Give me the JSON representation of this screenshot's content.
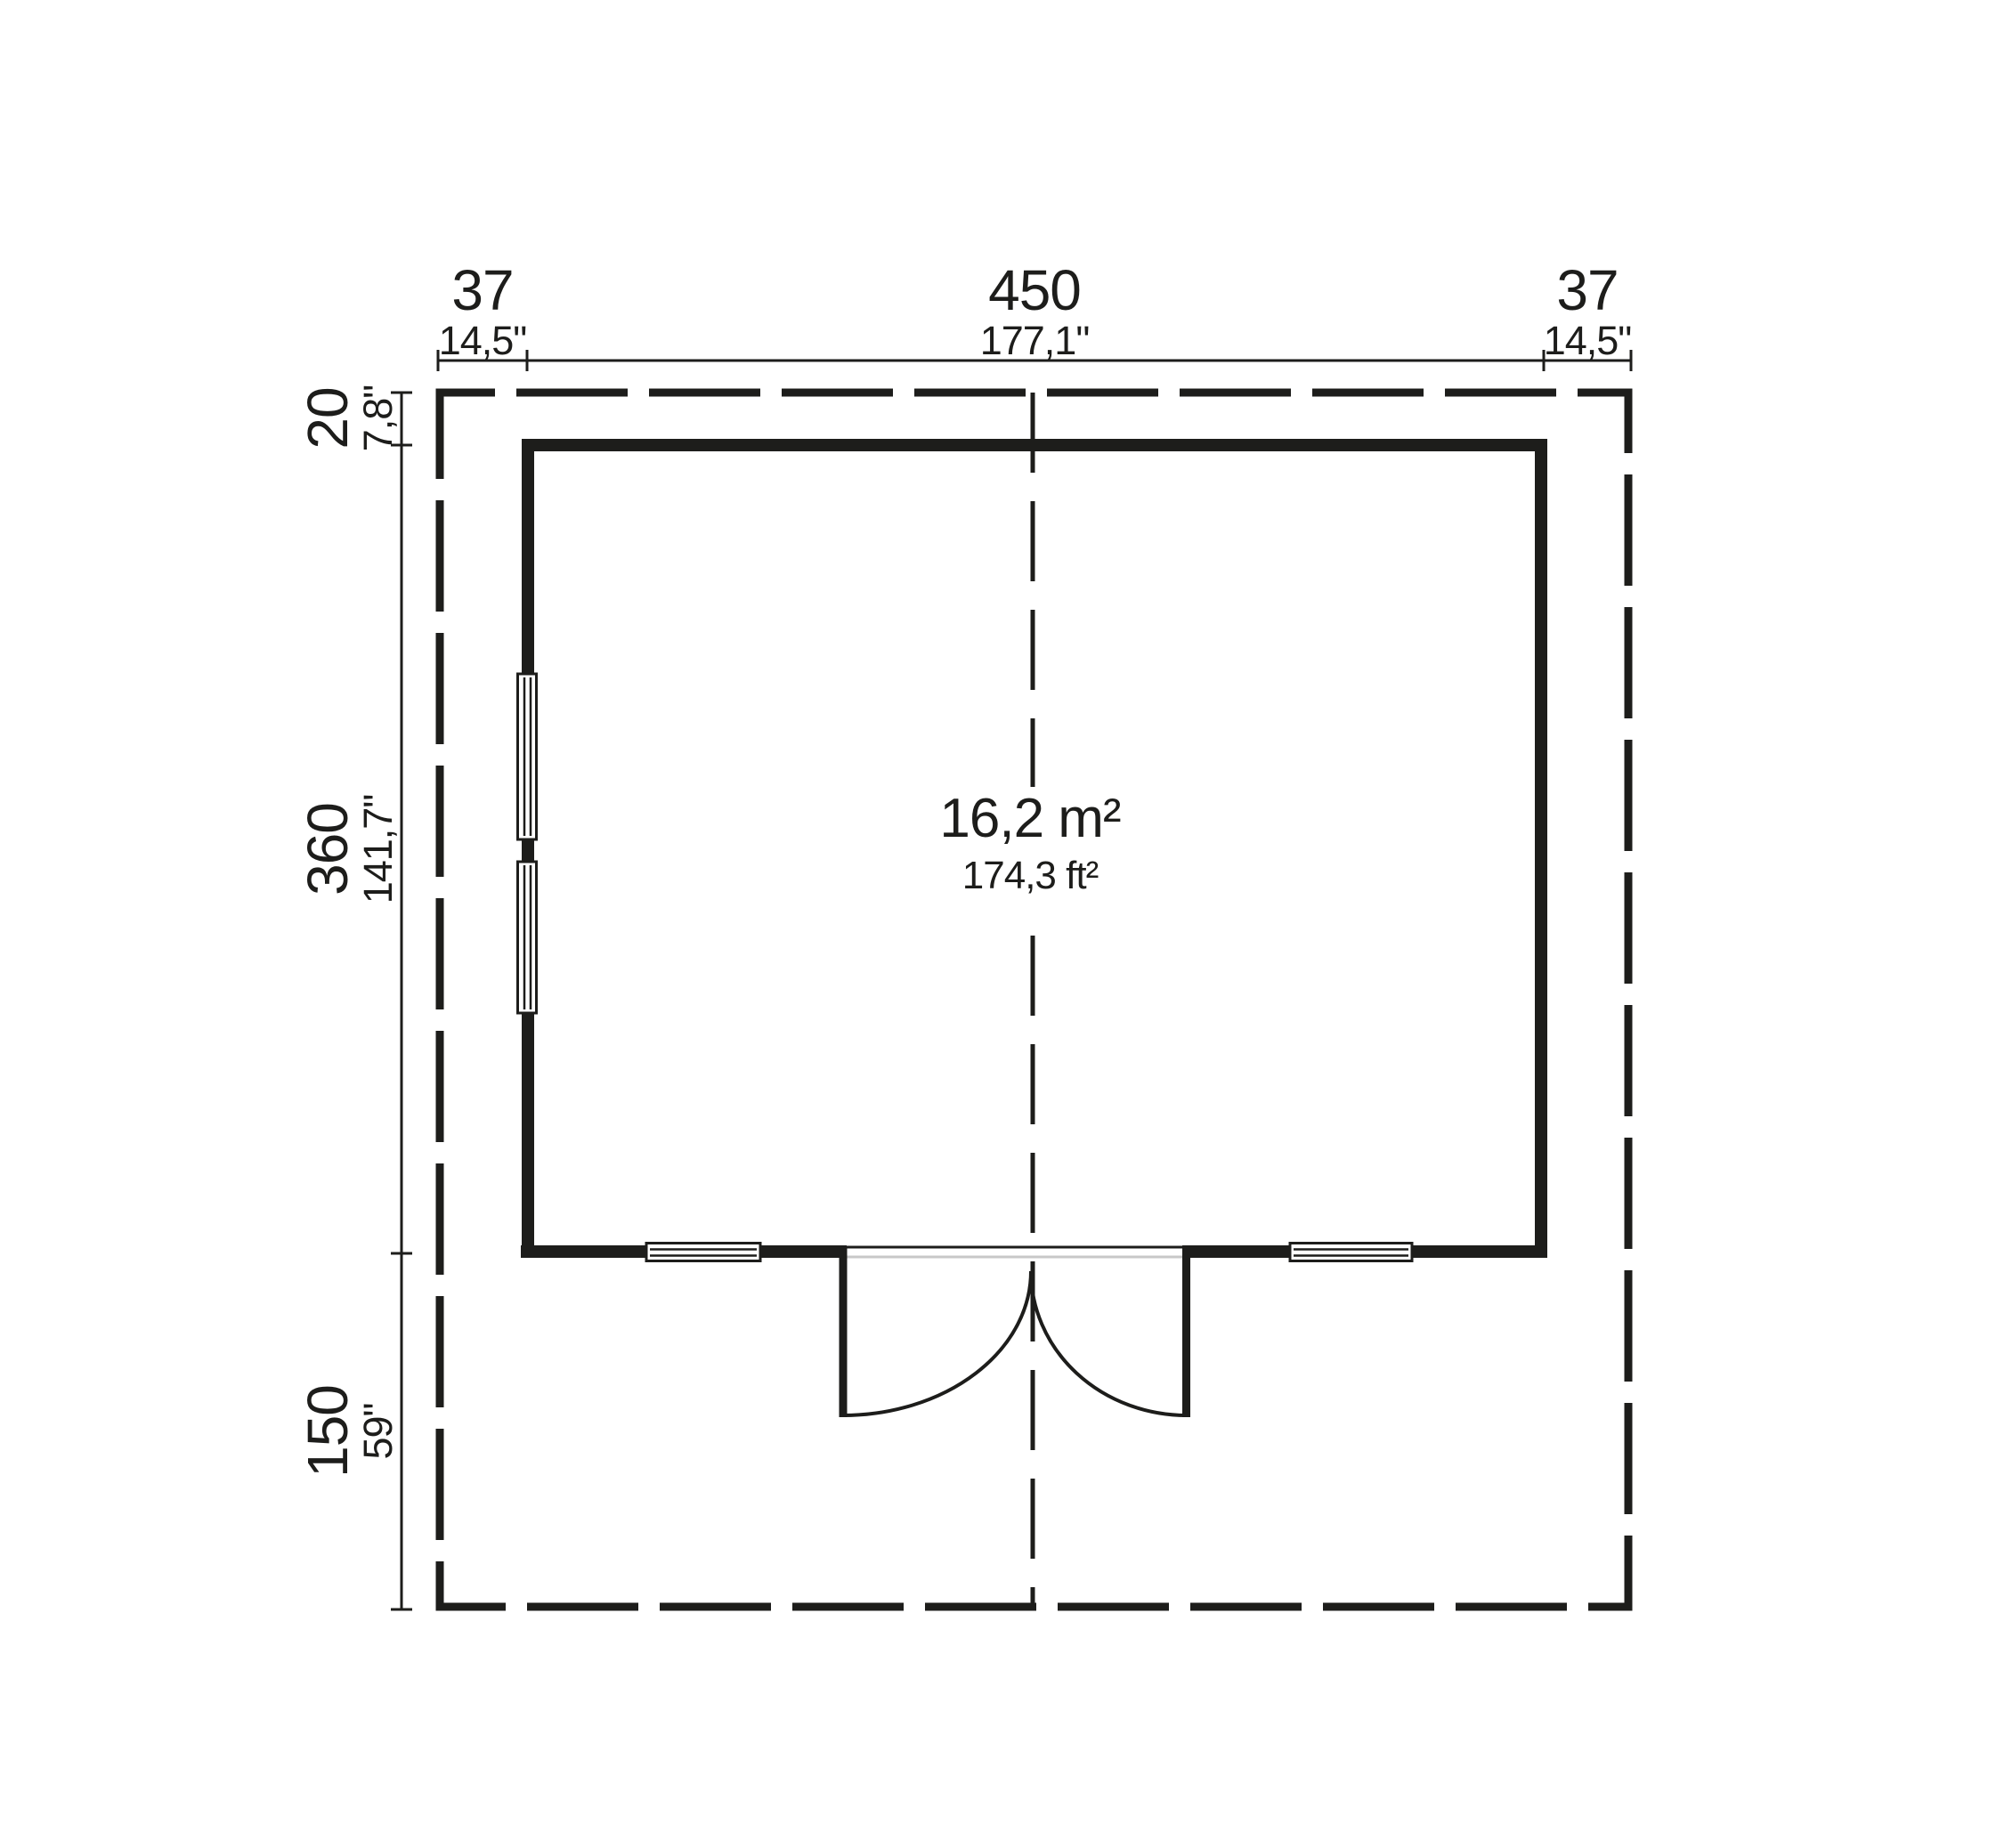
{
  "drawing": {
    "type": "floor-plan",
    "area": {
      "metric": "16,2 m²",
      "imperial": "174,3 ft²"
    },
    "dims_top": [
      {
        "cm": "37",
        "inch": "14,5\""
      },
      {
        "cm": "450",
        "inch": "177,1\""
      },
      {
        "cm": "37",
        "inch": "14,5\""
      }
    ],
    "dims_left": [
      {
        "cm": "20",
        "inch": "7,8\""
      },
      {
        "cm": "360",
        "inch": "141,7\""
      },
      {
        "cm": "150",
        "inch": "59\""
      }
    ],
    "colors": {
      "ink": "#1d1d1b",
      "threshold_gray": "#c8c8c8",
      "background": "#ffffff"
    }
  }
}
